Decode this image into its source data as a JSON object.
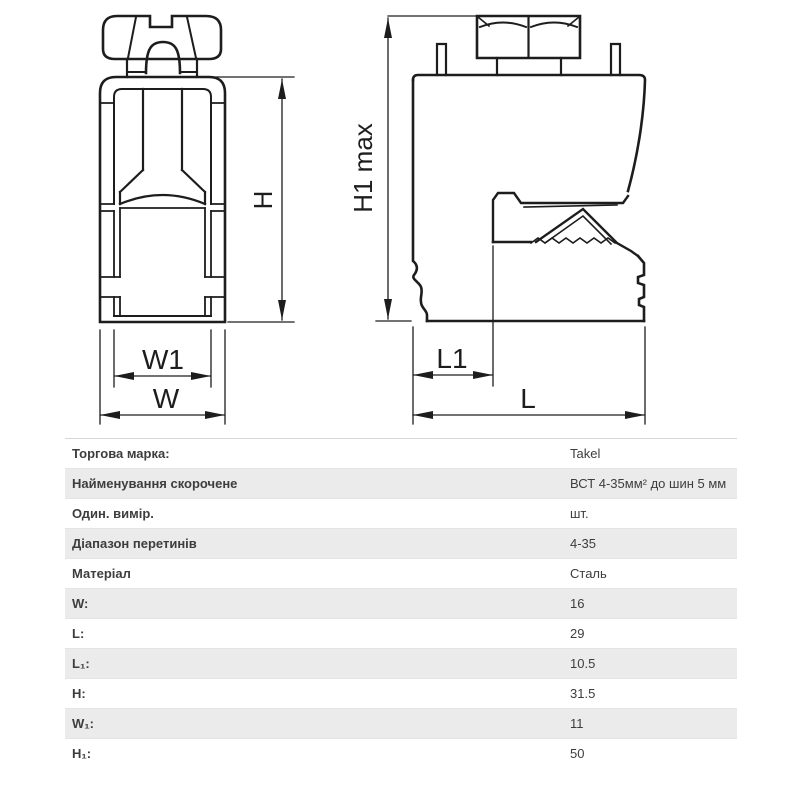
{
  "diagram": {
    "labels": {
      "h": "H",
      "h1_max": "H1 max",
      "w1": "W1",
      "w": "W",
      "l1": "L1",
      "l": "L"
    }
  },
  "spec_table": {
    "rows": [
      {
        "label": "Торгова марка:",
        "value": "Takel"
      },
      {
        "label": "Найменування скорочене",
        "value": "ВСТ 4-35мм² до шин 5 мм"
      },
      {
        "label": "Один. вимір.",
        "value": "шт."
      },
      {
        "label": "Діапазон перетинів",
        "value": "4-35"
      },
      {
        "label": "Матеріал",
        "value": "Сталь"
      },
      {
        "label": "W:",
        "value": "16"
      },
      {
        "label": "L:",
        "value": "29"
      },
      {
        "label": "L₁:",
        "value": "10.5"
      },
      {
        "label": "H:",
        "value": "31.5"
      },
      {
        "label": "W₁:",
        "value": "11"
      },
      {
        "label": "H₁:",
        "value": "50"
      }
    ]
  },
  "colors": {
    "line": "#1d1d1d",
    "table_alt_row": "#ebebeb",
    "table_text": "#3d3d3d",
    "background": "#ffffff"
  }
}
